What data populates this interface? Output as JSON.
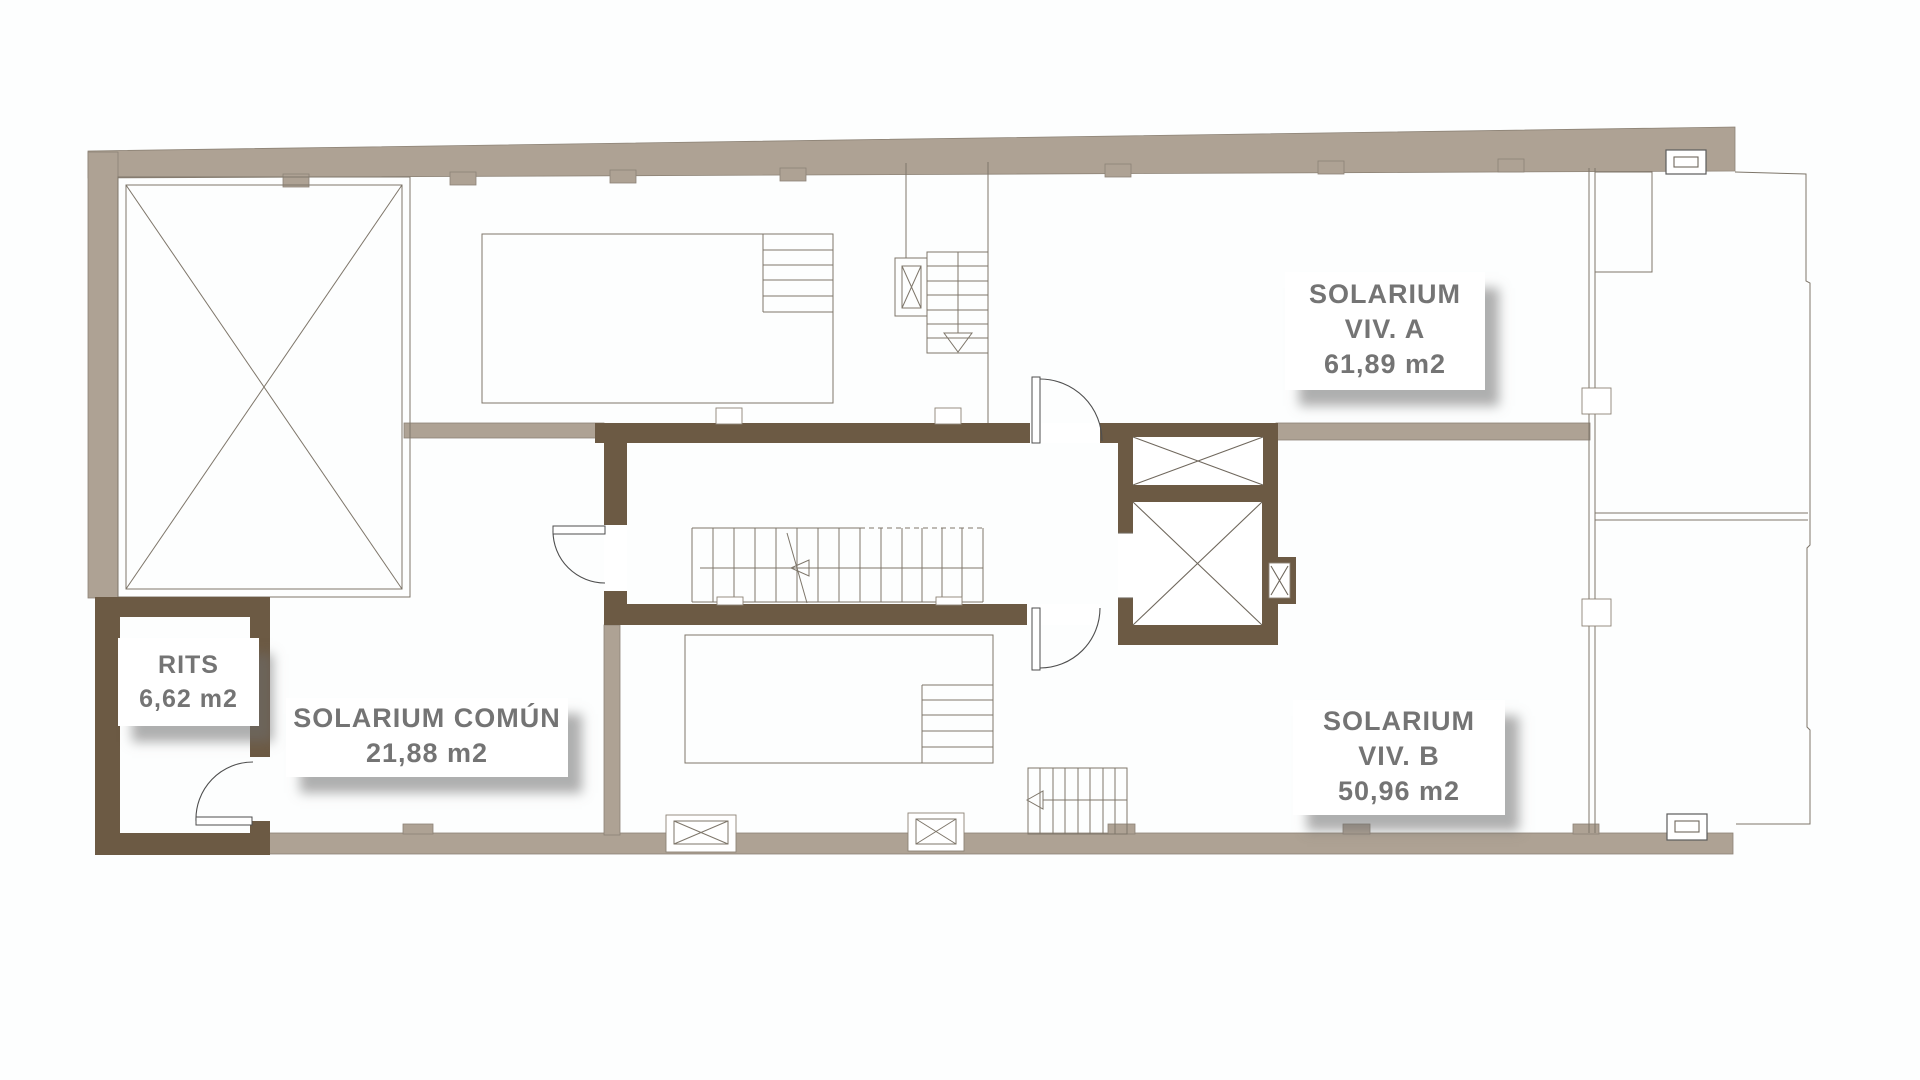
{
  "document": {
    "type": "architectural-floor-plan",
    "floor": "solarium / roof level"
  },
  "colors": {
    "wall_light": "#aea294",
    "wall_dark": "#6c5a44",
    "thin_line": "#7e766a",
    "door_line": "#4e4e4e",
    "label_text": "#747474",
    "label_background": "#ffffff",
    "label_shadow": "rgba(110,110,110,0.55)"
  },
  "rooms": {
    "rits": {
      "name": "RITS",
      "area": "6,62 m2"
    },
    "solarium_comun": {
      "name": "SOLARIUM COMÚN",
      "area": "21,88 m2"
    },
    "solarium_viv_a": {
      "name_line1": "SOLARIUM",
      "name_line2": "VIV. A",
      "area": "61,89 m2"
    },
    "solarium_viv_b": {
      "name_line1": "SOLARIUM",
      "name_line2": "VIV. B",
      "area": "50,96 m2"
    }
  },
  "features": {
    "staircase_main": "central staircase",
    "staircase_viv_a": "private stair viv. A",
    "staircase_viv_b": "private stair viv. B",
    "elevator": "elevator shafts",
    "skylight": "open shaft / patio",
    "pool_a": "pool viv. A",
    "pool_b": "pool viv. B"
  }
}
